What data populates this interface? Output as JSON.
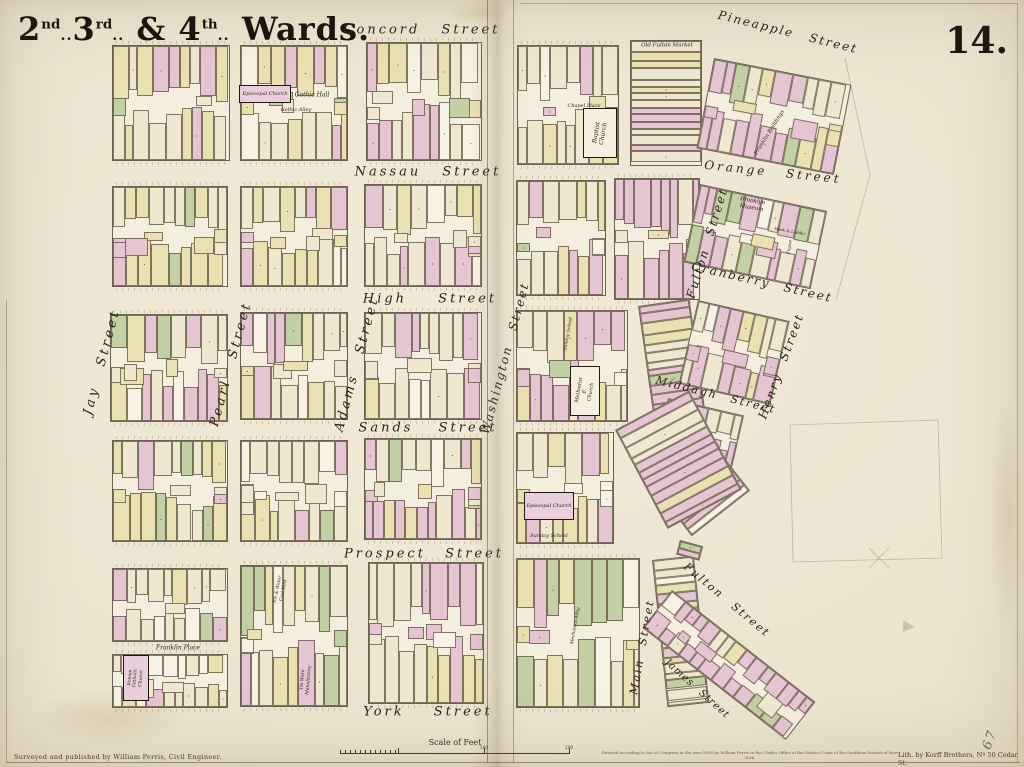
{
  "map": {
    "title": {
      "full": "2nd. 3rd. & 4th. Wards.",
      "parts": [
        {
          "base": "2",
          "sup": "nd",
          "tail": ".."
        },
        {
          "base": "3",
          "sup": "rd",
          "tail": ".."
        },
        {
          "base": " & "
        },
        {
          "base": "4",
          "sup": "th",
          "tail": ".."
        },
        {
          "base": " Wards."
        }
      ]
    },
    "plate_number": "14.",
    "pencil_note": "67"
  },
  "palette": {
    "paper": "#ece5d0",
    "block_bg": "#f3eedd",
    "pink": "#e6c5d3",
    "yellow": "#eae1b2",
    "green": "#c3cfa4",
    "cream": "#efe8d1",
    "white": "#f7f2e3",
    "outline": "#6a6150",
    "ink": "#28231c"
  },
  "streets": [
    {
      "label": "Concord Street",
      "x": 422,
      "y": 30,
      "rot": 0,
      "fs": 13,
      "ls": 3,
      "ws": 14
    },
    {
      "label": "Nassau Street",
      "x": 428,
      "y": 172,
      "rot": 0,
      "fs": 13,
      "ls": 3,
      "ws": 14
    },
    {
      "label": "High Street",
      "x": 430,
      "y": 299,
      "rot": 0,
      "fs": 13,
      "ls": 3,
      "ws": 24
    },
    {
      "label": "Sands Street",
      "x": 428,
      "y": 428,
      "rot": 0,
      "fs": 13,
      "ls": 3,
      "ws": 18
    },
    {
      "label": "Prospect Street",
      "x": 424,
      "y": 554,
      "rot": 0,
      "fs": 13,
      "ls": 3,
      "ws": 12
    },
    {
      "label": "York Street",
      "x": 428,
      "y": 712,
      "rot": 0,
      "fs": 13,
      "ls": 3,
      "ws": 22
    },
    {
      "label": "Jay Street",
      "x": 102,
      "y": 362,
      "rot": -75,
      "fs": 13,
      "ls": 3,
      "ws": 14
    },
    {
      "label": "Pearl Street",
      "x": 231,
      "y": 364,
      "rot": -75,
      "fs": 13,
      "ls": 3,
      "ws": 14
    },
    {
      "label": "Adams Street",
      "x": 357,
      "y": 364,
      "rot": -75,
      "fs": 13,
      "ls": 3,
      "ws": 14
    },
    {
      "label": "Washington Street",
      "x": 505,
      "y": 358,
      "rot": -75,
      "fs": 12,
      "ls": 2,
      "ws": 10
    },
    {
      "label": "Pineapple Street",
      "x": 788,
      "y": 32,
      "rot": 14,
      "fs": 12,
      "ls": 2,
      "ws": 10
    },
    {
      "label": "Orange Street",
      "x": 773,
      "y": 172,
      "rot": 6,
      "fs": 12,
      "ls": 3,
      "ws": 12
    },
    {
      "label": "Fulton Street",
      "x": 707,
      "y": 243,
      "rot": -73,
      "fs": 12,
      "ls": 2,
      "ws": 8
    },
    {
      "label": "Cranberry Street",
      "x": 762,
      "y": 282,
      "rot": 13,
      "fs": 12,
      "ls": 2,
      "ws": 8
    },
    {
      "label": "Middagh Street",
      "x": 716,
      "y": 395,
      "rot": 14,
      "fs": 11,
      "ls": 2,
      "ws": 8
    },
    {
      "label": "Henry Street",
      "x": 781,
      "y": 366,
      "rot": -70,
      "fs": 12,
      "ls": 2,
      "ws": 8
    },
    {
      "label": "Main Street",
      "x": 642,
      "y": 647,
      "rot": -80,
      "fs": 11,
      "ls": 2,
      "ws": 8
    },
    {
      "label": "James Street",
      "x": 697,
      "y": 689,
      "rot": 42,
      "fs": 10,
      "ls": 1,
      "ws": 6
    },
    {
      "label": "Fulton Street",
      "x": 727,
      "y": 600,
      "rot": 40,
      "fs": 11,
      "ls": 2,
      "ws": 8
    }
  ],
  "landmarks": [
    {
      "label": "Episcopal Church",
      "cx": 265,
      "cy": 94,
      "w": 52,
      "h": 18,
      "boxed": true,
      "fill": "pink",
      "trot": 0,
      "fs": 5
    },
    {
      "label": "Gothic Hall",
      "cx": 312,
      "cy": 95,
      "boxed": false,
      "trot": 0,
      "fs": 6
    },
    {
      "label": "Gothic Alley",
      "cx": 296,
      "cy": 110,
      "boxed": false,
      "trot": 0,
      "fs": 5
    },
    {
      "label": "Chapel Place",
      "cx": 584,
      "cy": 106,
      "boxed": false,
      "trot": 0,
      "fs": 5
    },
    {
      "label": "Baptist Church",
      "cx": 600,
      "cy": 133,
      "w": 34,
      "h": 50,
      "boxed": true,
      "fill": "cream",
      "trot": -80,
      "fs": 6
    },
    {
      "label": "Old Fulton Market",
      "cx": 667,
      "cy": 46,
      "boxed": false,
      "trot": 0,
      "fs": 5.5
    },
    {
      "label": "Franklin Buildings",
      "cx": 770,
      "cy": 133,
      "boxed": false,
      "trot": -58,
      "fs": 5.5
    },
    {
      "label": "Brooklyn\nMuseum",
      "cx": 752,
      "cy": 205,
      "boxed": false,
      "trot": 10,
      "fs": 5.5
    },
    {
      "label": "Hook & Ladder",
      "cx": 790,
      "cy": 231,
      "boxed": false,
      "trot": 10,
      "fs": 4
    },
    {
      "label": "Engine",
      "cx": 789,
      "cy": 247,
      "boxed": false,
      "trot": -80,
      "fs": 4
    },
    {
      "label": "Sunday School",
      "cx": 569,
      "cy": 334,
      "boxed": false,
      "trot": -80,
      "fs": 4.5
    },
    {
      "label": "Methodist E.\nChurch",
      "cx": 585,
      "cy": 391,
      "w": 30,
      "h": 50,
      "boxed": true,
      "fill": "cream",
      "trot": -80,
      "fs": 5
    },
    {
      "label": "Episcopal Church",
      "cx": 549,
      "cy": 506,
      "w": 50,
      "h": 28,
      "boxed": true,
      "fill": "pink",
      "trot": 0,
      "fs": 5
    },
    {
      "label": "Sunday School",
      "cx": 549,
      "cy": 536,
      "boxed": false,
      "trot": 0,
      "fs": 5
    },
    {
      "label": "Franklin Place",
      "cx": 178,
      "cy": 648,
      "boxed": false,
      "trot": 0,
      "fs": 6
    },
    {
      "label": "Roman Catholic\nChurch",
      "cx": 136,
      "cy": 678,
      "w": 26,
      "h": 46,
      "boxed": true,
      "fill": "pink",
      "trot": -85,
      "fs": 4.5
    },
    {
      "label": "Ice & Water\nCoal Yard",
      "cx": 281,
      "cy": 590,
      "boxed": false,
      "trot": -78,
      "fs": 4.5
    },
    {
      "label": "Tin Ware\nManufactory",
      "cx": 306,
      "cy": 680,
      "boxed": false,
      "trot": -85,
      "fs": 4.5
    },
    {
      "label": "Mechanics Alley",
      "cx": 576,
      "cy": 626,
      "boxed": false,
      "trot": -80,
      "fs": 4.5
    }
  ],
  "blocks": [
    {
      "x": 112,
      "y": 45,
      "w": 116,
      "h": 114,
      "rot": 0,
      "type": "grid",
      "mix": "std"
    },
    {
      "x": 240,
      "y": 45,
      "w": 106,
      "h": 114,
      "rot": 0,
      "type": "grid",
      "mix": "yellow"
    },
    {
      "x": 366,
      "y": 42,
      "w": 114,
      "h": 117,
      "rot": 0,
      "type": "grid",
      "mix": "std"
    },
    {
      "x": 112,
      "y": 186,
      "w": 114,
      "h": 99,
      "rot": 0,
      "type": "grid",
      "mix": "std"
    },
    {
      "x": 240,
      "y": 186,
      "w": 106,
      "h": 99,
      "rot": 0,
      "type": "grid",
      "mix": "yellow"
    },
    {
      "x": 364,
      "y": 184,
      "w": 116,
      "h": 101,
      "rot": 0,
      "type": "grid",
      "mix": "std"
    },
    {
      "x": 110,
      "y": 314,
      "w": 116,
      "h": 106,
      "rot": 0,
      "type": "grid",
      "mix": "pinkish"
    },
    {
      "x": 240,
      "y": 312,
      "w": 106,
      "h": 106,
      "rot": 0,
      "type": "grid",
      "mix": "yellow"
    },
    {
      "x": 364,
      "y": 312,
      "w": 116,
      "h": 106,
      "rot": 0,
      "type": "grid",
      "mix": "plain"
    },
    {
      "x": 112,
      "y": 440,
      "w": 114,
      "h": 100,
      "rot": 0,
      "type": "grid",
      "mix": "std"
    },
    {
      "x": 240,
      "y": 440,
      "w": 106,
      "h": 100,
      "rot": 0,
      "type": "grid",
      "mix": "plain"
    },
    {
      "x": 364,
      "y": 438,
      "w": 116,
      "h": 100,
      "rot": 0,
      "type": "grid",
      "mix": "pinkish"
    },
    {
      "x": 112,
      "y": 568,
      "w": 114,
      "h": 72,
      "rot": 0,
      "type": "grid",
      "mix": "plain"
    },
    {
      "x": 112,
      "y": 654,
      "w": 114,
      "h": 52,
      "rot": 0,
      "type": "grid",
      "mix": "plain"
    },
    {
      "x": 240,
      "y": 565,
      "w": 106,
      "h": 140,
      "rot": 0,
      "type": "grid",
      "mix": "green"
    },
    {
      "x": 368,
      "y": 562,
      "w": 114,
      "h": 140,
      "rot": 0,
      "type": "grid",
      "mix": "plainpink"
    },
    {
      "x": 517,
      "y": 45,
      "w": 100,
      "h": 118,
      "rot": 0,
      "type": "grid",
      "mix": "std"
    },
    {
      "x": 630,
      "y": 40,
      "w": 70,
      "h": 124,
      "rot": 0,
      "type": "rows",
      "mix": "pink"
    },
    {
      "x": 714,
      "y": 58,
      "w": 138,
      "h": 90,
      "rot": 11,
      "type": "grid",
      "mix": "pink"
    },
    {
      "x": 516,
      "y": 180,
      "w": 88,
      "h": 114,
      "rot": 0,
      "type": "grid",
      "mix": "std"
    },
    {
      "x": 614,
      "y": 178,
      "w": 84,
      "h": 120,
      "rot": 0,
      "type": "grid",
      "mix": "pink"
    },
    {
      "x": 700,
      "y": 184,
      "w": 128,
      "h": 78,
      "rot": 12,
      "type": "grid",
      "mix": "green"
    },
    {
      "x": 516,
      "y": 310,
      "w": 110,
      "h": 110,
      "rot": 0,
      "type": "grid",
      "mix": "pinkish"
    },
    {
      "x": 638,
      "y": 306,
      "w": 50,
      "h": 112,
      "rot": -8,
      "type": "rows",
      "mix": "pink"
    },
    {
      "x": 698,
      "y": 300,
      "w": 92,
      "h": 84,
      "rot": 13,
      "type": "grid",
      "mix": "pink"
    },
    {
      "x": 668,
      "y": 398,
      "w": 76,
      "h": 54,
      "rot": 13,
      "type": "grid",
      "mix": "pink"
    },
    {
      "x": 640,
      "y": 470,
      "w": 72,
      "h": 82,
      "rot": -38,
      "type": "rows",
      "mix": "pink"
    },
    {
      "x": 516,
      "y": 432,
      "w": 96,
      "h": 110,
      "rot": 0,
      "type": "grid",
      "mix": "std"
    },
    {
      "x": 615,
      "y": 430,
      "w": 82,
      "h": 110,
      "rot": -28,
      "type": "rows",
      "mix": "pink"
    },
    {
      "x": 516,
      "y": 558,
      "w": 122,
      "h": 148,
      "rot": 0,
      "type": "grid",
      "mix": "green"
    },
    {
      "x": 652,
      "y": 560,
      "w": 40,
      "h": 146,
      "rot": -6,
      "type": "rows",
      "mix": "std"
    },
    {
      "x": 680,
      "y": 540,
      "w": 22,
      "h": 13,
      "rot": 15,
      "type": "rows",
      "mix": "green"
    },
    {
      "x": 672,
      "y": 590,
      "w": 180,
      "h": 46,
      "rot": 38,
      "type": "grid",
      "mix": "pink"
    }
  ],
  "faint_lines": [
    "M845,58 L870,175 L836,300",
    "M790,425 L938,420 L942,558 L793,562 Z",
    "M869,548 L889,568",
    "M889,548 L869,568"
  ],
  "faint_triangle": "M903,620 L915,627 L903,632 Z",
  "scale_bar": {
    "label": "Scale of Feet",
    "segment_labels": [
      "100",
      "200"
    ]
  },
  "credits": {
    "surveyor": "Surveyed and published by William Perris, Civil Engineer.",
    "copyright": "Entered according to Act of Congress in the year 1855 by William Perris in the Clerk's Office of the District Court of the Southern District of New York.",
    "lithographer": "Lith. by Korff Brothers, Nº 50 Cedar St."
  }
}
